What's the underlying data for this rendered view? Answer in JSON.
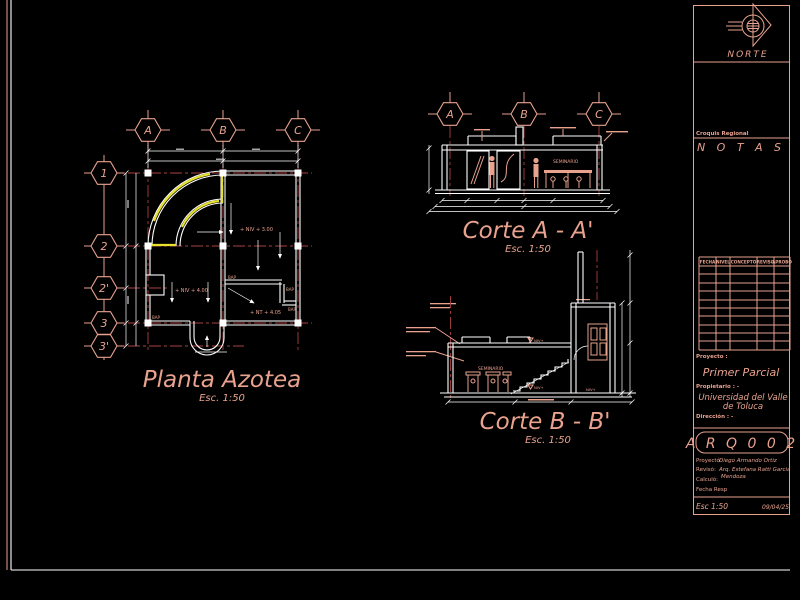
{
  "colors": {
    "background": "#000000",
    "salmon": "#e8a28e",
    "grid_red": "#a84040",
    "white": "#ffffff",
    "highlight_yellow": "#e6e22e"
  },
  "planta": {
    "title": "Planta Azotea",
    "scale": "Esc. 1:50",
    "cols": [
      "A",
      "B",
      "C"
    ],
    "rows": [
      "1",
      "2",
      "2'",
      "3",
      "3'"
    ],
    "level_1": "+ NIV + 3.00",
    "level_2": "+ NIV + 4.00",
    "level_3": "+ NT + 4.05",
    "drain_label": "BAP"
  },
  "corte_a": {
    "title": "Corte A - A'",
    "scale": "Esc. 1:50",
    "cols": [
      "A",
      "B",
      "C"
    ],
    "room_label": "SEMINARIO"
  },
  "corte_b": {
    "title": "Corte B - B'",
    "scale": "Esc. 1:50",
    "room_label": "SEMINARIO",
    "level_mark": "NIV+"
  },
  "titleblock": {
    "north_label": "NORTE",
    "croquis_label": "Croquis Regional",
    "notes_title": "N O T A S",
    "revision_headers": [
      "FECHA",
      "NIVEL",
      "CONCEPTO",
      "REVISO",
      "APROBO"
    ],
    "project_label": "Proyecto :",
    "project_value": "Primer Parcial",
    "owner_label": "Propietario : -",
    "owner_value_line1": "Universidad del Valle",
    "owner_value_line2": "de Toluca",
    "address_label": "Dirección : -",
    "sheet_code": "A R Q 0 0 2",
    "designed_label": "Proyectó:",
    "designed_value": "Diego Armando Ortiz",
    "reviewed_label": "Revisó:",
    "reviewed_value_line1": "Arq. Estefana Ratti Garcia",
    "reviewed_value_line2": "Mendoza",
    "calculated_label": "Calculó:",
    "date_resp_label": "Fecha Resp",
    "scale_label": "Esc 1:50",
    "date_value": "09/04/25"
  }
}
